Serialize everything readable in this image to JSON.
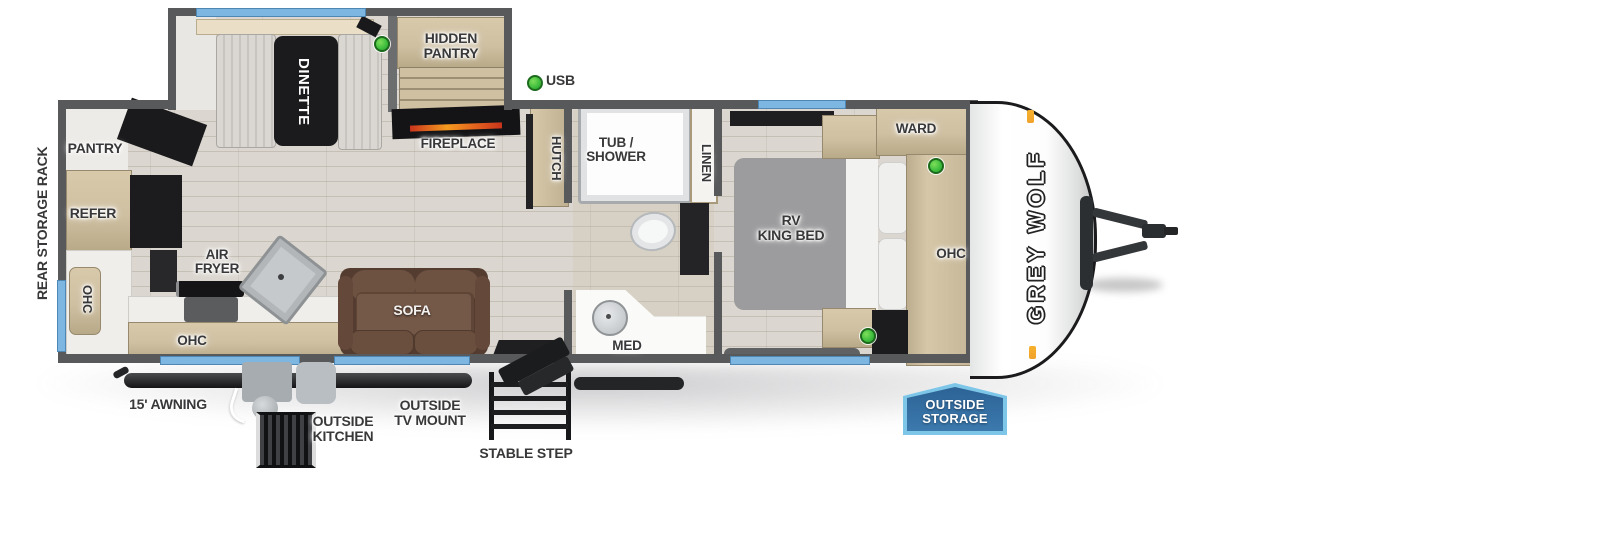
{
  "colors": {
    "wall": "#58595b",
    "floor": "#dbd6cf",
    "window_blue": "#7db6e0",
    "wood_tan": "#cfc0a2",
    "accent_green": "#3cbc3c",
    "marker_orange": "#f0a22b",
    "badge_fill_top": "#2d6396",
    "badge_fill_bottom": "#3c79ad",
    "badge_border": "#7ec6e8",
    "sofa_brown": "#6d5242",
    "bed_gray": "#9c9c9e",
    "label_text": "#38383a"
  },
  "exterior": {
    "rear_rack_label": "REAR STORAGE RACK",
    "awning_label": "15' AWNING",
    "outside_kitchen_label": [
      "OUTSIDE",
      "KITCHEN"
    ],
    "outside_tv_label": [
      "OUTSIDE",
      "TV MOUNT"
    ],
    "stable_step_label": "STABLE STEP",
    "outside_storage_badge": [
      "OUTSIDE",
      "STORAGE"
    ],
    "usb_label": "USB",
    "brand_logo": "GREY WOLF"
  },
  "galley": {
    "pantry_label": "PANTRY",
    "refer_label": "REFER",
    "ohc_rear_label": "OHC",
    "ohc_kitchen_label": "OHC",
    "air_fryer_label": [
      "AIR",
      "FRYER"
    ]
  },
  "living": {
    "dinette_label": "DINETTE",
    "hidden_pantry_label": [
      "HIDDEN",
      "PANTRY"
    ],
    "fireplace_label": "FIREPLACE",
    "hutch_label": "HUTCH",
    "sofa_label": "SOFA"
  },
  "bathroom": {
    "tub_shower_label": [
      "TUB /",
      "SHOWER"
    ],
    "linen_label": "LINEN",
    "med_label": "MED"
  },
  "bedroom": {
    "bed_label": [
      "RV",
      "KING BED"
    ],
    "ward_label": "WARD",
    "ohc_label": "OHC"
  }
}
